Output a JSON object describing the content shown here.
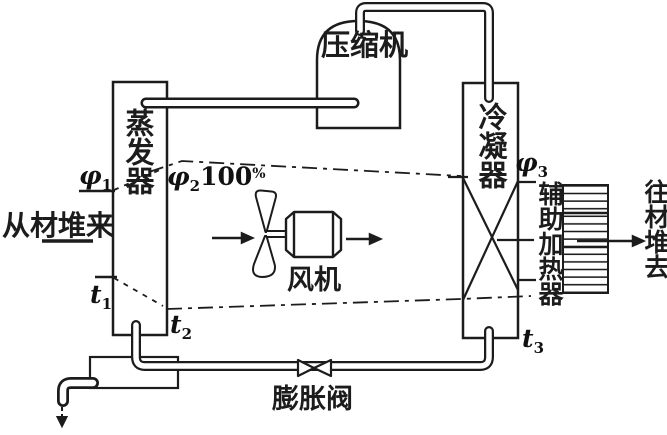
{
  "figure": {
    "background": "#ffffff",
    "ink": "#1c1c1c",
    "type": "heat-pump timber drying cycle schematic"
  },
  "components": {
    "evaporator": {
      "label": "蒸发器"
    },
    "compressor": {
      "label": "压缩机"
    },
    "condenser": {
      "label": "冷凝器"
    },
    "fan": {
      "label": "风机"
    },
    "expansion_valve": {
      "label": "膨胀阀"
    },
    "aux_heater": {
      "label": "辅助加热器"
    }
  },
  "air_flow": {
    "inlet": {
      "label": "从材堆来"
    },
    "outlet": {
      "label": "往材堆去"
    }
  },
  "state_points": {
    "phi1": {
      "base": "φ",
      "sub": "1"
    },
    "phi2": {
      "base": "φ",
      "sub": "2",
      "value": "100",
      "pct": "%"
    },
    "phi3": {
      "base": "φ",
      "sub": "3"
    },
    "t1": {
      "base": "t",
      "sub": "1"
    },
    "t2": {
      "base": "t",
      "sub": "2"
    },
    "t3": {
      "base": "t",
      "sub": "3"
    }
  }
}
